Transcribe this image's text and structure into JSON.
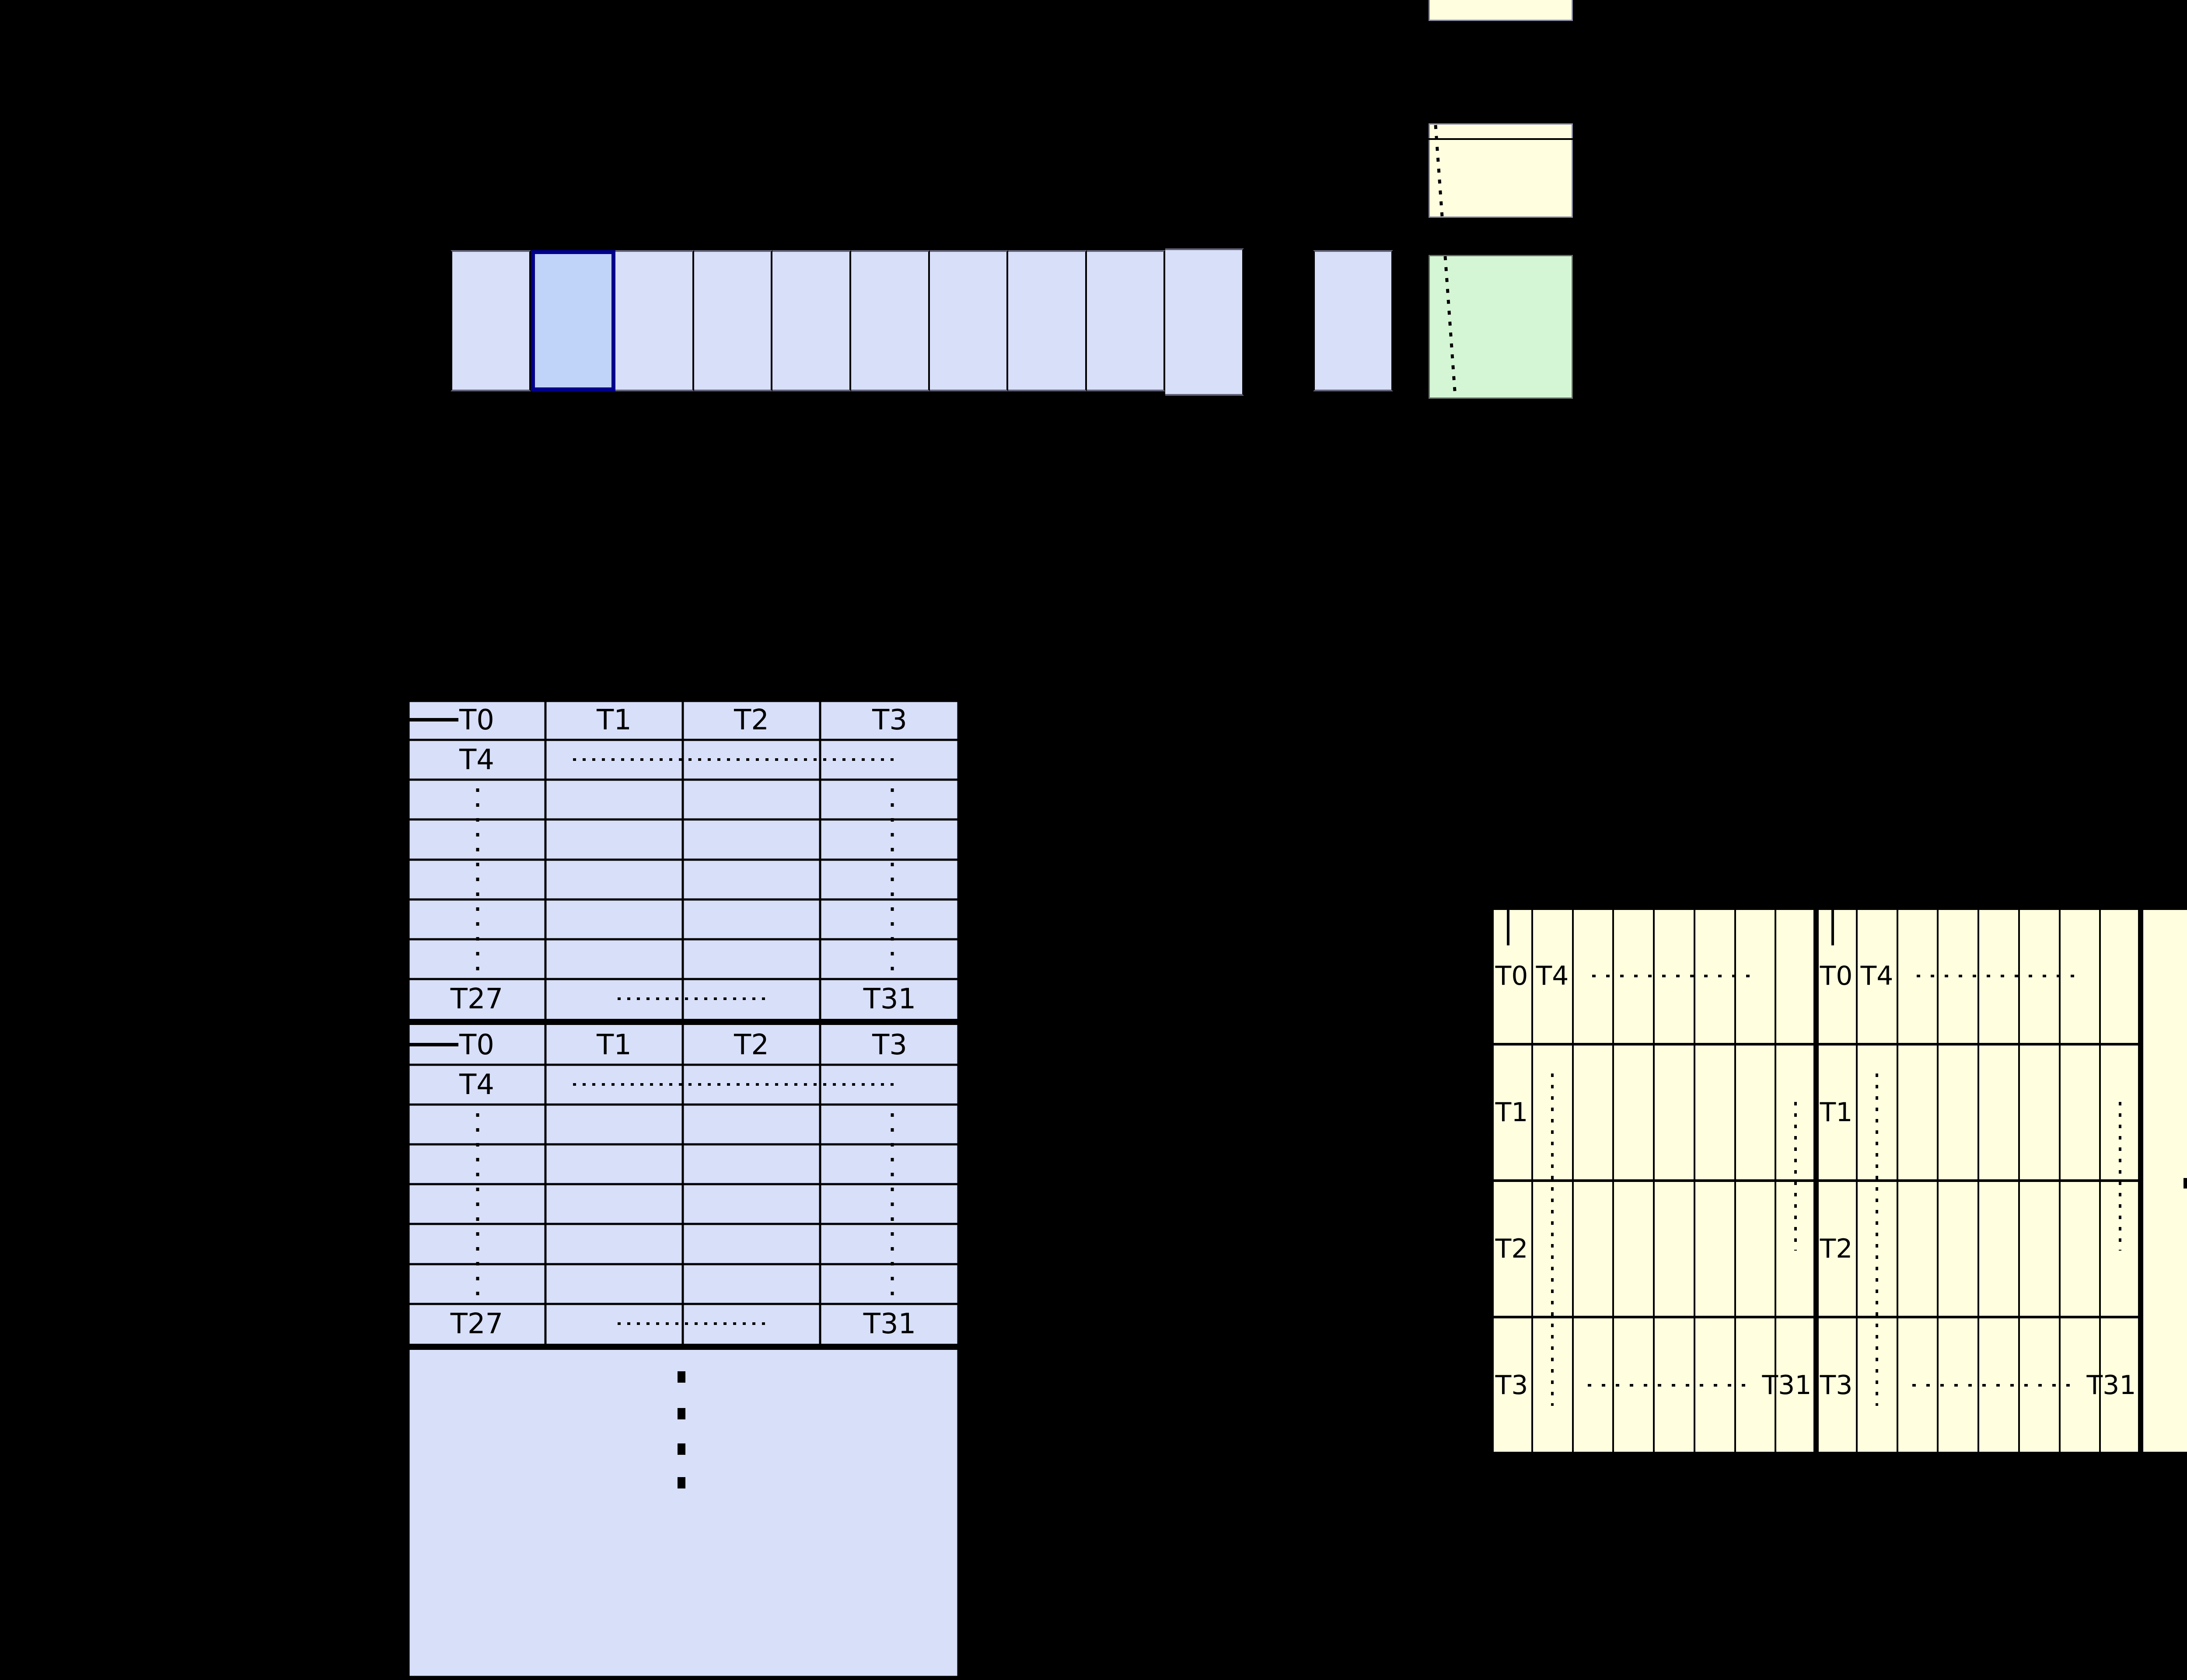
{
  "figure": {
    "description_note": "black-background diagram: a row of blue slots (one highlighted), yellow and green boxes with a dotted pointer line, a blue 4-column thread table repeated in blocks, and a yellow banked thread table",
    "top_row": {
      "cell_count": 10,
      "highlighted_index": 1
    },
    "left_table": {
      "col_headers": [
        "T0",
        "T1",
        "T2",
        "T3"
      ],
      "second_row_label": "T4",
      "last_row_left": "T27",
      "last_row_right": "T31"
    },
    "right_table": {
      "row1_labels": [
        "T0",
        "T4"
      ],
      "row2_label": "T1",
      "row3_label": "T2",
      "row4_label": "T3",
      "row4_right_label": "T31"
    }
  },
  "colors": {
    "cell_fill": "#d8dff8",
    "cell_highlight_fill": "#c0d3f8",
    "highlight_border": "#00008b",
    "yellow_fill": "#ffffe0",
    "green_fill": "#d5f6d5",
    "line": "#000000",
    "background": "#000000"
  }
}
